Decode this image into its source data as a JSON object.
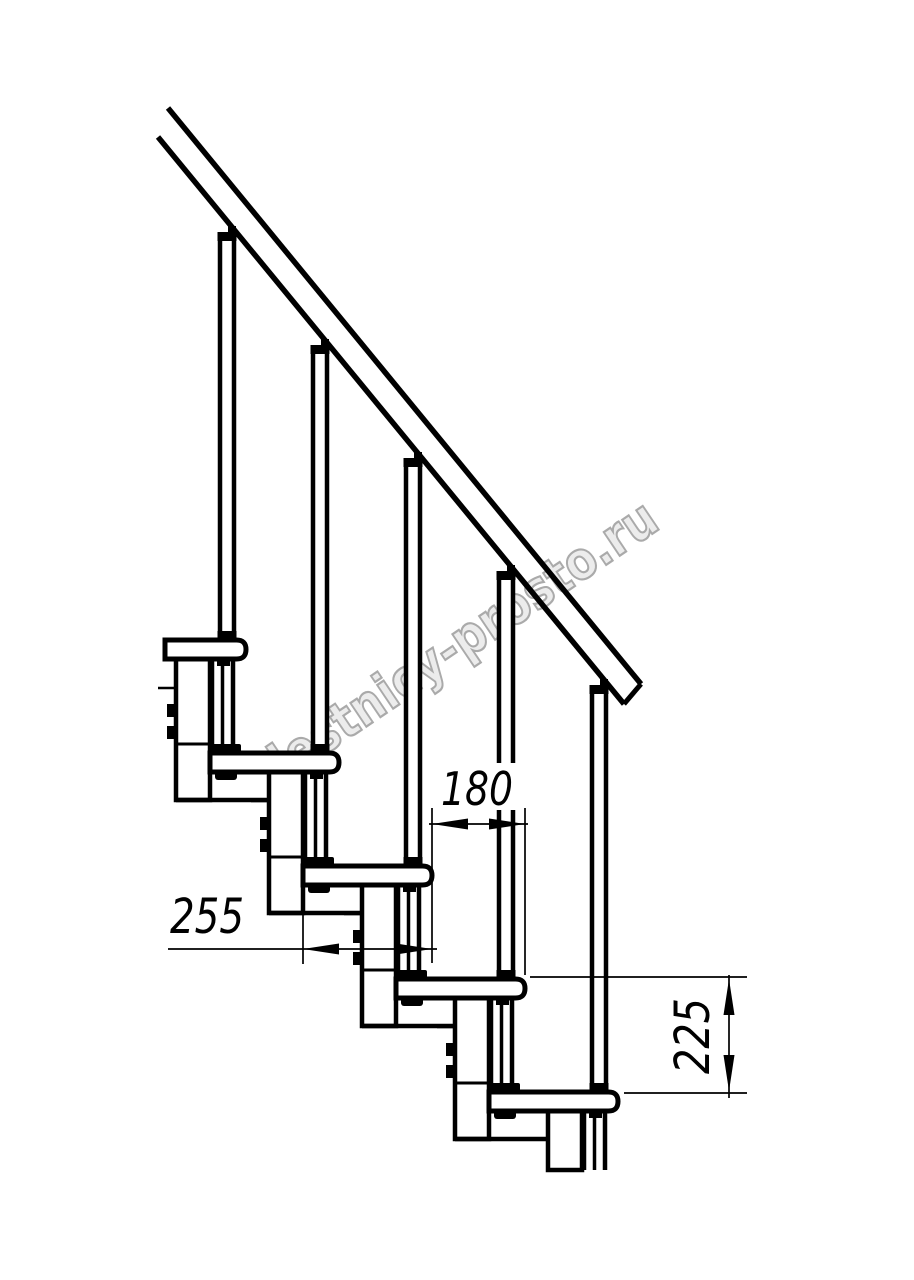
{
  "page": {
    "background": "#ffffff"
  },
  "drawing": {
    "watermark": {
      "text": "lestnicy-prosto.ru",
      "fill": "#ececec",
      "stroke": "#a6a6a6"
    },
    "dimensions": {
      "step_run": "180",
      "tread_depth": "255",
      "step_rise": "225"
    },
    "line_color": "#000000"
  }
}
